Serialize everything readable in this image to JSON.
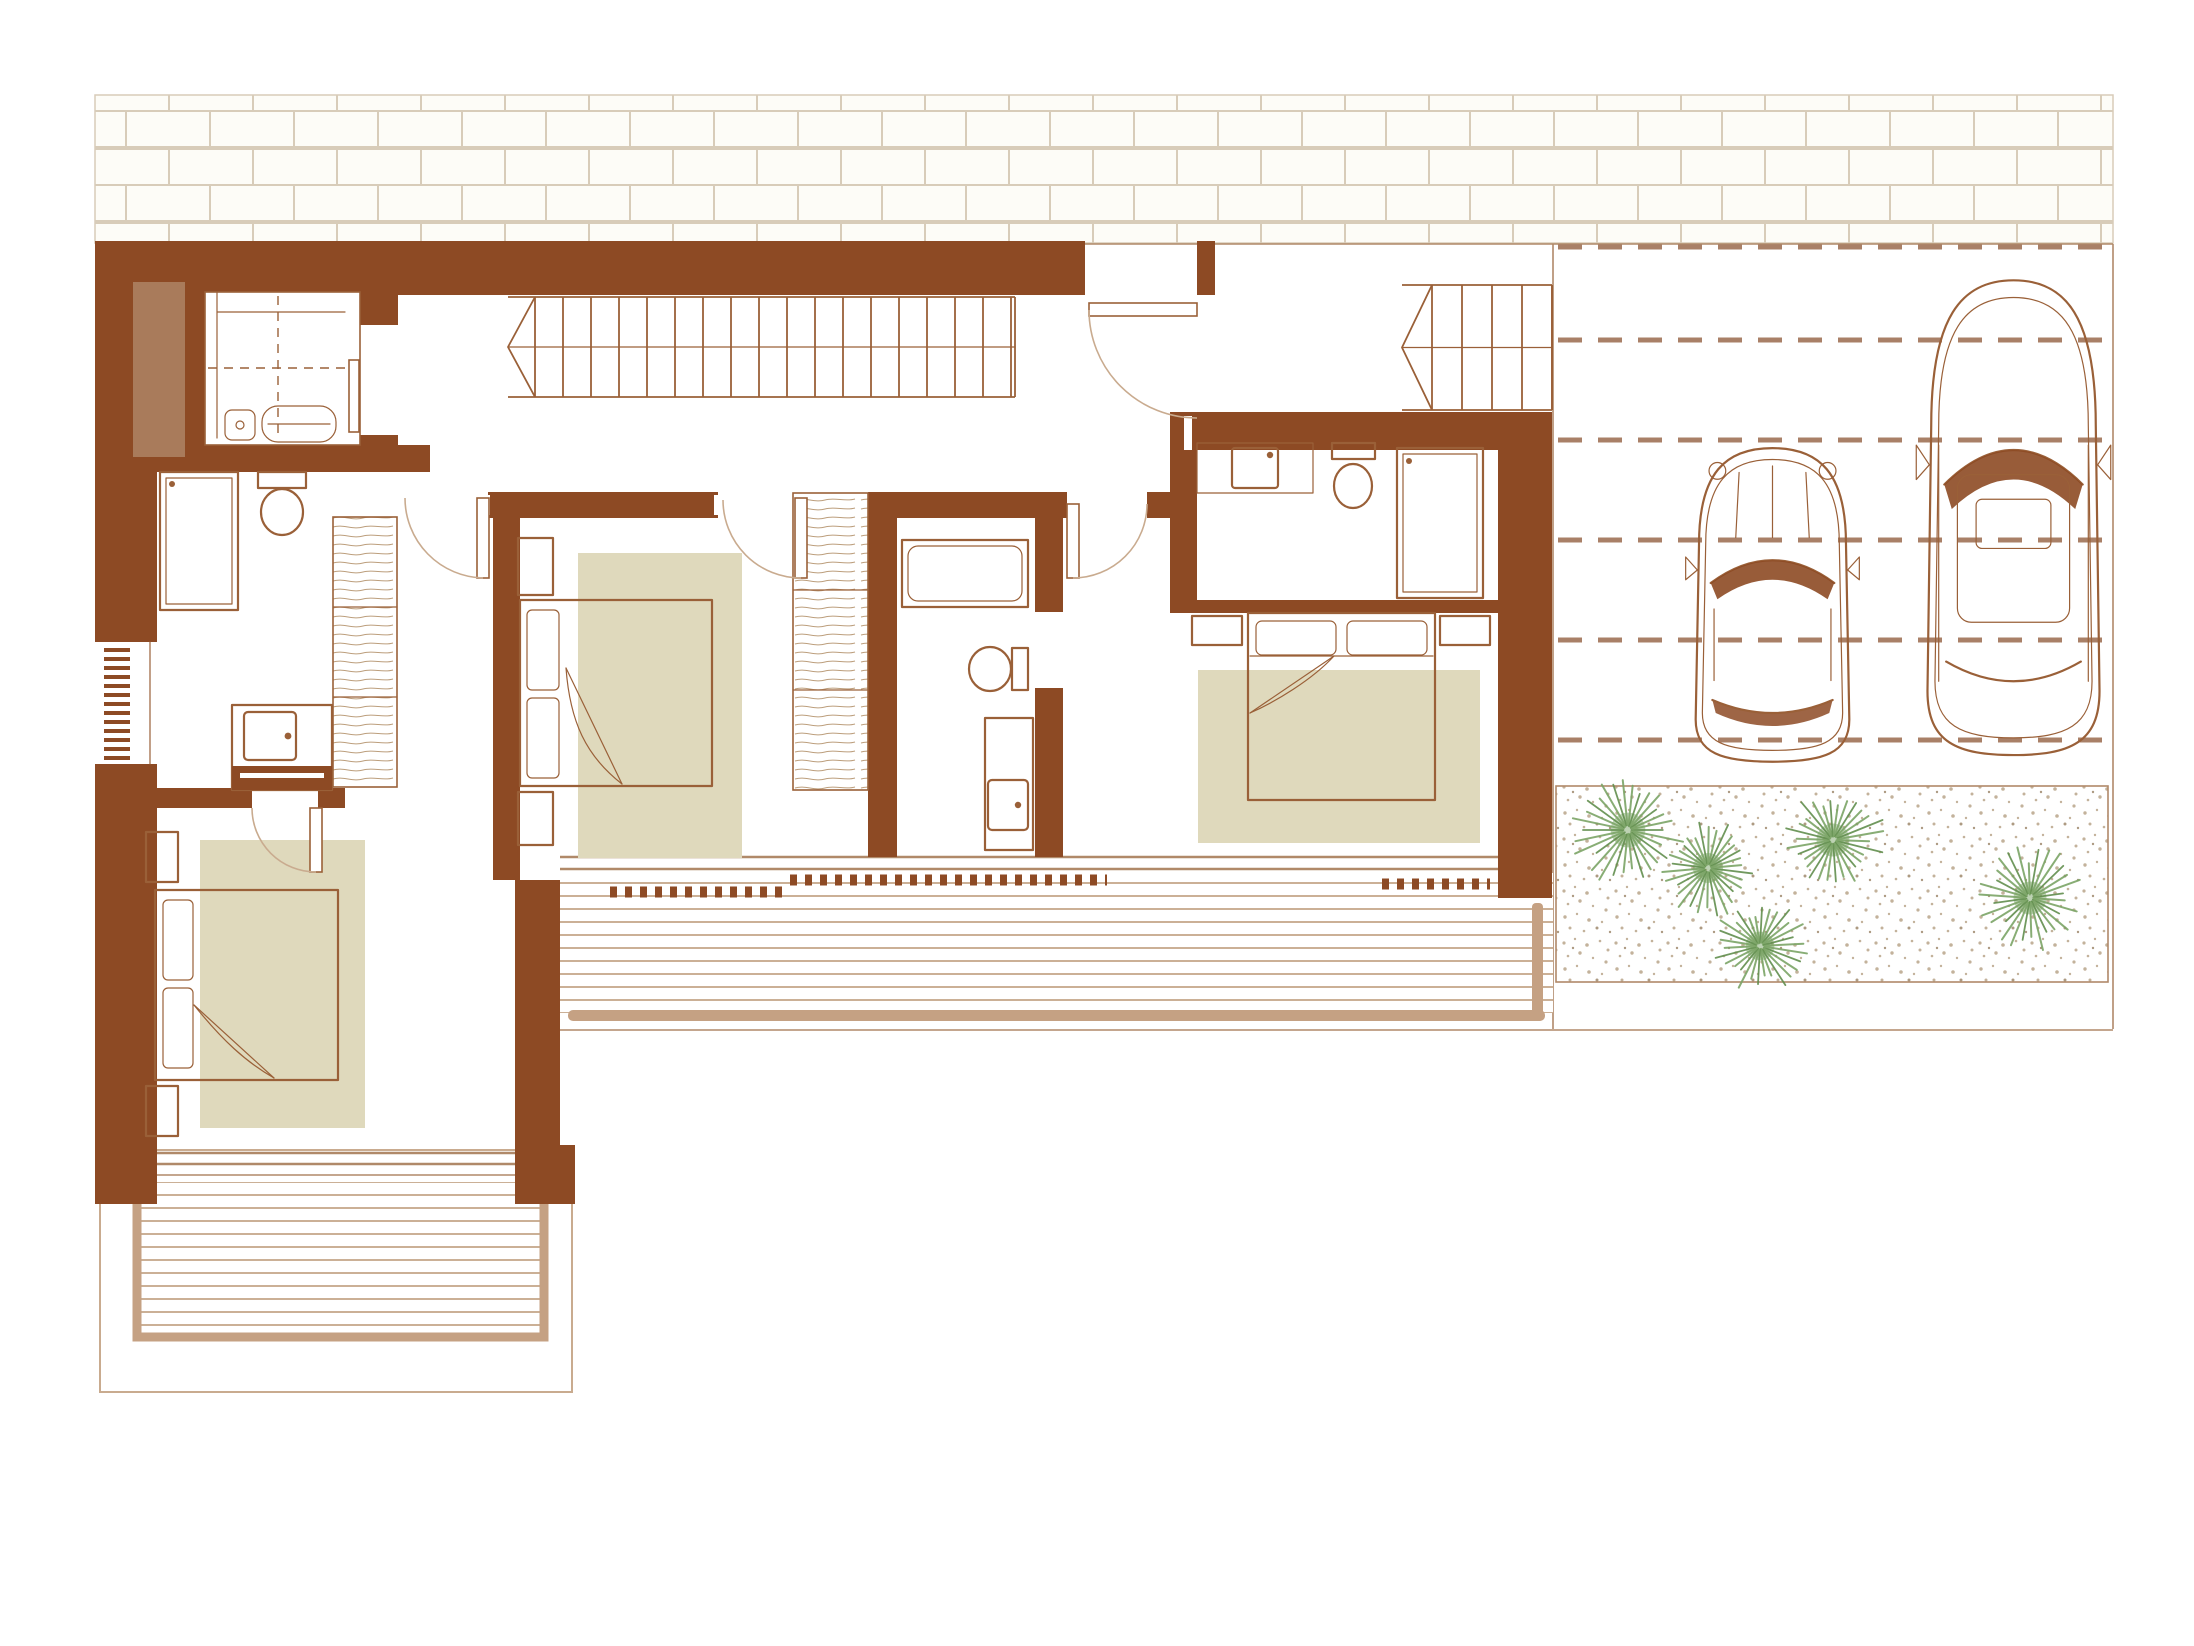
{
  "document": {
    "kind": "architectural-floor-plan",
    "notes": "terracotta line drawing of an upper floor with three bedrooms, three bathrooms, elevator, two staircases, two wooden decks, carport with two cars and a gravel garden"
  },
  "colors": {
    "wall": "#8D4A24",
    "wall_light": "#A97B5B",
    "line": "#9A6038",
    "line_soft": "#C9AB8F",
    "glass": "#B08969",
    "rug": "#DFD9BC",
    "deck_line": "#CBB096",
    "deck_frame": "#C5A183",
    "plant": "#7CA567",
    "plant_dark": "#628F4E",
    "gravel_dot": "#C3B29B",
    "mortar": "#D8CCB9",
    "dash": "#A98067",
    "paper": "#FFFFFF"
  },
  "garage": {
    "x1": 1558,
    "x2": 2106,
    "lane_dashes_y": [
      247,
      340,
      440,
      540,
      640,
      740
    ],
    "cars": [
      {
        "kind": "compact-car",
        "x": 1689,
        "y": 440,
        "w": 167,
        "h": 325
      },
      {
        "kind": "suv-car",
        "x": 1920,
        "y": 268,
        "w": 187,
        "h": 492
      }
    ]
  },
  "garden": {
    "plants": [
      {
        "x": 1628,
        "y": 830,
        "r": 58
      },
      {
        "x": 1708,
        "y": 868,
        "r": 50
      },
      {
        "x": 1833,
        "y": 840,
        "r": 55
      },
      {
        "x": 1760,
        "y": 946,
        "r": 48
      },
      {
        "x": 2030,
        "y": 898,
        "r": 55
      }
    ]
  },
  "stairs": [
    {
      "id": "main-staircase",
      "x1": 508,
      "x2": 1015,
      "y1": 297,
      "y2": 397,
      "first": 535,
      "step": 28
    },
    {
      "id": "garage-staircase",
      "x1": 1402,
      "x2": 1552,
      "y1": 285,
      "y2": 410,
      "first": 1432,
      "step": 30
    }
  ],
  "deck_tracks": [
    {
      "x1": 610,
      "x2": 786,
      "y": 892
    },
    {
      "x1": 790,
      "x2": 1107,
      "y": 880
    },
    {
      "x1": 1382,
      "x2": 1490,
      "y": 884
    }
  ],
  "radiator": {
    "x": 104,
    "y": 648,
    "w": 26,
    "count": 13,
    "gap": 9
  }
}
